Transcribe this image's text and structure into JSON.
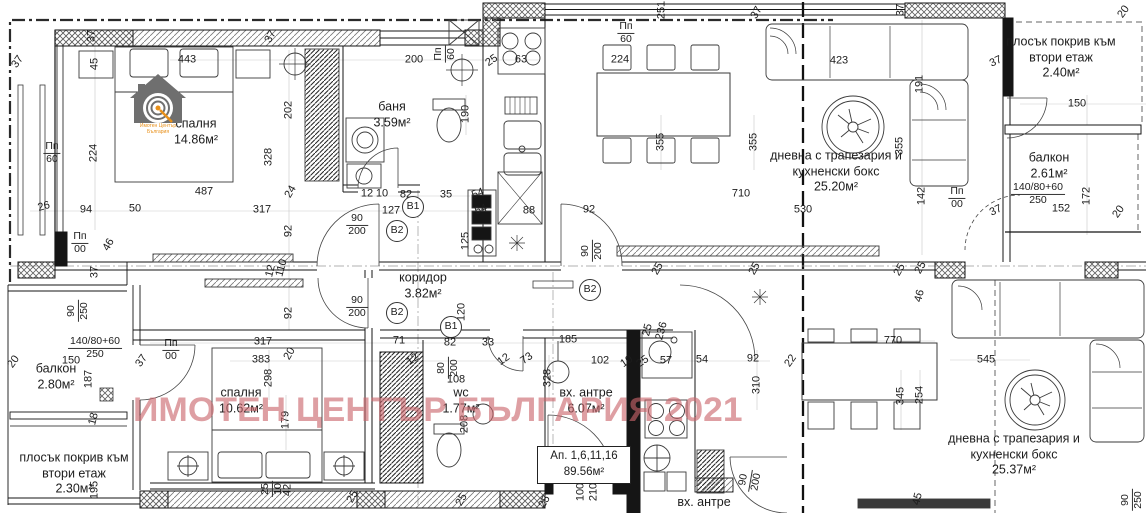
{
  "watermark": {
    "text": "ИМОТЕН ЦЕНТЪР БЪЛГАРИЯ 2021",
    "color": "#c9646a"
  },
  "logo": {
    "line1": "Имотен Център",
    "line2": "България",
    "house_color": "#6f6f6f",
    "accent_color": "#e8901a"
  },
  "apartment_box": {
    "line1": "Ап. 1,6,11,16",
    "line2": "89.56м²"
  },
  "rooms": [
    {
      "name": "спалня",
      "area": "14.86м²",
      "x": 196,
      "y": 132
    },
    {
      "name": "баня",
      "area": "3.59м²",
      "x": 392,
      "y": 115
    },
    {
      "name": "коридор",
      "area": "3.82м²",
      "x": 423,
      "y": 286
    },
    {
      "name": "спалня",
      "area": "10.62м²",
      "x": 241,
      "y": 401
    },
    {
      "name": "wc",
      "area": "1.77м²",
      "x": 461,
      "y": 401
    },
    {
      "name": "вх. антре",
      "area": "6.07м²",
      "x": 586,
      "y": 401
    },
    {
      "name": "балкон",
      "area": "2.80м²",
      "x": 56,
      "y": 377
    },
    {
      "name": "балкон",
      "area": "2.61м²",
      "x": 1049,
      "y": 166
    },
    {
      "name": "дневна с трапезария и кухненски бокс",
      "area": "25.20м²",
      "x": 836,
      "y": 172
    },
    {
      "name": "дневна с трапезария и кухненски бокс",
      "area": "25.37м²",
      "x": 1014,
      "y": 455
    },
    {
      "name": "плосък покрив към втори етаж",
      "area": "2.40м²",
      "x": 1061,
      "y": 58
    },
    {
      "name": "плосък покрив към втори етаж",
      "area": "2.30м²",
      "x": 74,
      "y": 474
    },
    {
      "name": "вх. антре",
      "area": "",
      "x": 704,
      "y": 503
    }
  ],
  "markers": [
    {
      "t": "B1",
      "x": 413,
      "y": 207
    },
    {
      "t": "B2",
      "x": 397,
      "y": 231
    },
    {
      "t": "B2",
      "x": 590,
      "y": 290
    },
    {
      "t": "B2",
      "x": 397,
      "y": 313
    },
    {
      "t": "B1",
      "x": 451,
      "y": 327
    }
  ],
  "fractions": [
    {
      "a": "90",
      "b": "200",
      "x": 357,
      "y": 225,
      "r": 0
    },
    {
      "a": "90",
      "b": "200",
      "x": 357,
      "y": 307,
      "r": 0
    },
    {
      "a": "90",
      "b": "200",
      "x": 592,
      "y": 251,
      "r": -90
    },
    {
      "a": "Пп",
      "b": "60",
      "x": 52,
      "y": 153,
      "r": 0
    },
    {
      "a": "Пп",
      "b": "00",
      "x": 80,
      "y": 243,
      "r": 0
    },
    {
      "a": "Пп",
      "b": "00",
      "x": 171,
      "y": 350,
      "r": 0
    },
    {
      "a": "Пп",
      "b": "00",
      "x": 957,
      "y": 198,
      "r": 0
    },
    {
      "a": "Пп",
      "b": "60",
      "x": 626,
      "y": 33,
      "r": 0
    },
    {
      "a": "Пп",
      "b": "60",
      "x": 445,
      "y": 54,
      "r": -90
    },
    {
      "a": "90",
      "b": "250",
      "x": 78,
      "y": 311,
      "r": -90
    },
    {
      "a": "90",
      "b": "250",
      "x": 1132,
      "y": 500,
      "r": -90
    },
    {
      "a": "90",
      "b": "200",
      "x": 750,
      "y": 481,
      "r": -80
    },
    {
      "a": "80",
      "b": "200",
      "x": 448,
      "y": 368,
      "r": -90
    },
    {
      "a": "25",
      "b": "10",
      "x": 272,
      "y": 489,
      "r": -90
    },
    {
      "a": "140/80+60",
      "b": "250",
      "x": 95,
      "y": 348,
      "r": 0
    },
    {
      "a": "140/80+60",
      "b": "250",
      "x": 1038,
      "y": 194,
      "r": 0
    }
  ],
  "dimensions": [
    {
      "t": "37",
      "x": 18,
      "y": 62,
      "r": -55
    },
    {
      "t": "37",
      "x": 92,
      "y": 36,
      "r": -90
    },
    {
      "t": "45",
      "x": 95,
      "y": 64,
      "r": -90
    },
    {
      "t": "443",
      "x": 187,
      "y": 60,
      "r": 0
    },
    {
      "t": "37",
      "x": 271,
      "y": 37,
      "r": -60
    },
    {
      "t": "224",
      "x": 94,
      "y": 153,
      "r": -90
    },
    {
      "t": "202",
      "x": 289,
      "y": 110,
      "r": -90
    },
    {
      "t": "328",
      "x": 269,
      "y": 157,
      "r": -90
    },
    {
      "t": "487",
      "x": 204,
      "y": 192,
      "r": 0
    },
    {
      "t": "26",
      "x": 44,
      "y": 207,
      "r": -15
    },
    {
      "t": "94",
      "x": 86,
      "y": 210,
      "r": 0
    },
    {
      "t": "50",
      "x": 135,
      "y": 209,
      "r": 0
    },
    {
      "t": "46",
      "x": 109,
      "y": 245,
      "r": -60
    },
    {
      "t": "37",
      "x": 95,
      "y": 272,
      "r": -90
    },
    {
      "t": "317",
      "x": 262,
      "y": 210,
      "r": 0
    },
    {
      "t": "24",
      "x": 291,
      "y": 192,
      "r": -60
    },
    {
      "t": "12",
      "x": 367,
      "y": 194,
      "r": 0
    },
    {
      "t": "10",
      "x": 382,
      "y": 194,
      "r": 0
    },
    {
      "t": "82",
      "x": 406,
      "y": 195,
      "r": 0
    },
    {
      "t": "127",
      "x": 391,
      "y": 211,
      "r": 0
    },
    {
      "t": "35",
      "x": 446,
      "y": 195,
      "r": 0
    },
    {
      "t": "54",
      "x": 478,
      "y": 194,
      "r": -20
    },
    {
      "t": "54",
      "x": 481,
      "y": 210,
      "r": -20
    },
    {
      "t": "125",
      "x": 466,
      "y": 241,
      "r": -90
    },
    {
      "t": "88",
      "x": 529,
      "y": 211,
      "r": 0
    },
    {
      "t": "92",
      "x": 589,
      "y": 210,
      "r": 0
    },
    {
      "t": "710",
      "x": 741,
      "y": 194,
      "r": 0
    },
    {
      "t": "200",
      "x": 414,
      "y": 60,
      "r": 0
    },
    {
      "t": "25",
      "x": 492,
      "y": 61,
      "r": -35
    },
    {
      "t": "63",
      "x": 521,
      "y": 60,
      "r": 0
    },
    {
      "t": "190",
      "x": 466,
      "y": 114,
      "r": -90
    },
    {
      "t": "251",
      "x": 662,
      "y": 10,
      "r": -90
    },
    {
      "t": "37",
      "x": 757,
      "y": 13,
      "r": -60
    },
    {
      "t": "224",
      "x": 620,
      "y": 60,
      "r": 0
    },
    {
      "t": "355",
      "x": 661,
      "y": 142,
      "r": -90
    },
    {
      "t": "355",
      "x": 754,
      "y": 142,
      "r": -90
    },
    {
      "t": "423",
      "x": 839,
      "y": 61,
      "r": 0
    },
    {
      "t": "191",
      "x": 920,
      "y": 84,
      "r": -90
    },
    {
      "t": "355",
      "x": 900,
      "y": 146,
      "r": -90
    },
    {
      "t": "37",
      "x": 901,
      "y": 10,
      "r": -90
    },
    {
      "t": "20",
      "x": 1124,
      "y": 12,
      "r": -55
    },
    {
      "t": "37",
      "x": 996,
      "y": 62,
      "r": -25
    },
    {
      "t": "150",
      "x": 1077,
      "y": 104,
      "r": 0
    },
    {
      "t": "530",
      "x": 803,
      "y": 210,
      "r": 0
    },
    {
      "t": "142",
      "x": 922,
      "y": 196,
      "r": -90
    },
    {
      "t": "37",
      "x": 996,
      "y": 211,
      "r": -25
    },
    {
      "t": "152",
      "x": 1061,
      "y": 209,
      "r": 0
    },
    {
      "t": "172",
      "x": 1087,
      "y": 196,
      "r": -90
    },
    {
      "t": "20",
      "x": 1119,
      "y": 212,
      "r": -55
    },
    {
      "t": "92",
      "x": 289,
      "y": 231,
      "r": -90
    },
    {
      "t": "92",
      "x": 289,
      "y": 313,
      "r": -90
    },
    {
      "t": "12",
      "x": 271,
      "y": 271,
      "r": -75
    },
    {
      "t": "110",
      "x": 282,
      "y": 268,
      "r": -75
    },
    {
      "t": "25",
      "x": 658,
      "y": 269,
      "r": -60
    },
    {
      "t": "25",
      "x": 755,
      "y": 269,
      "r": -60
    },
    {
      "t": "25",
      "x": 900,
      "y": 270,
      "r": -60
    },
    {
      "t": "25",
      "x": 921,
      "y": 268,
      "r": -60
    },
    {
      "t": "46",
      "x": 920,
      "y": 296,
      "r": -75
    },
    {
      "t": "120",
      "x": 462,
      "y": 312,
      "r": -90
    },
    {
      "t": "82",
      "x": 450,
      "y": 343,
      "r": 0
    },
    {
      "t": "71",
      "x": 399,
      "y": 341,
      "r": 0
    },
    {
      "t": "33",
      "x": 488,
      "y": 343,
      "r": 0
    },
    {
      "t": "185",
      "x": 568,
      "y": 340,
      "r": 0
    },
    {
      "t": "12",
      "x": 413,
      "y": 360,
      "r": -35
    },
    {
      "t": "12",
      "x": 504,
      "y": 360,
      "r": -35
    },
    {
      "t": "73",
      "x": 527,
      "y": 359,
      "r": -35
    },
    {
      "t": "108",
      "x": 456,
      "y": 380,
      "r": 0
    },
    {
      "t": "328",
      "x": 548,
      "y": 378,
      "r": -90
    },
    {
      "t": "102",
      "x": 600,
      "y": 361,
      "r": 0
    },
    {
      "t": "10",
      "x": 627,
      "y": 362,
      "r": -35
    },
    {
      "t": "25",
      "x": 643,
      "y": 362,
      "r": -35
    },
    {
      "t": "57",
      "x": 666,
      "y": 361,
      "r": 0
    },
    {
      "t": "54",
      "x": 702,
      "y": 360,
      "r": 0
    },
    {
      "t": "92",
      "x": 753,
      "y": 359,
      "r": 0
    },
    {
      "t": "310",
      "x": 757,
      "y": 385,
      "r": -90
    },
    {
      "t": "208",
      "x": 465,
      "y": 424,
      "r": -90
    },
    {
      "t": "317",
      "x": 263,
      "y": 342,
      "r": 0
    },
    {
      "t": "383",
      "x": 261,
      "y": 360,
      "r": 0
    },
    {
      "t": "20",
      "x": 290,
      "y": 354,
      "r": -60
    },
    {
      "t": "298",
      "x": 269,
      "y": 378,
      "r": -90
    },
    {
      "t": "179",
      "x": 286,
      "y": 420,
      "r": -90
    },
    {
      "t": "187",
      "x": 89,
      "y": 379,
      "r": -90
    },
    {
      "t": "37",
      "x": 142,
      "y": 361,
      "r": -55
    },
    {
      "t": "20",
      "x": 14,
      "y": 362,
      "r": -55
    },
    {
      "t": "150",
      "x": 71,
      "y": 361,
      "r": 0
    },
    {
      "t": "18",
      "x": 94,
      "y": 419,
      "r": -75
    },
    {
      "t": "195",
      "x": 95,
      "y": 490,
      "r": -90
    },
    {
      "t": "42",
      "x": 288,
      "y": 490,
      "r": -90
    },
    {
      "t": "100",
      "x": 581,
      "y": 492,
      "r": -90
    },
    {
      "t": "210",
      "x": 594,
      "y": 492,
      "r": -90
    },
    {
      "t": "25",
      "x": 462,
      "y": 500,
      "r": -60
    },
    {
      "t": "25",
      "x": 545,
      "y": 502,
      "r": -60
    },
    {
      "t": "25",
      "x": 353,
      "y": 497,
      "r": -60
    },
    {
      "t": "770",
      "x": 893,
      "y": 341,
      "r": 0
    },
    {
      "t": "545",
      "x": 986,
      "y": 360,
      "r": 0
    },
    {
      "t": "345",
      "x": 901,
      "y": 396,
      "r": -90
    },
    {
      "t": "254",
      "x": 920,
      "y": 395,
      "r": -90
    },
    {
      "t": "22",
      "x": 791,
      "y": 361,
      "r": -55
    },
    {
      "t": "45",
      "x": 918,
      "y": 499,
      "r": -75
    },
    {
      "t": "236",
      "x": 662,
      "y": 331,
      "r": -75
    },
    {
      "t": "25",
      "x": 648,
      "y": 330,
      "r": -75
    }
  ]
}
